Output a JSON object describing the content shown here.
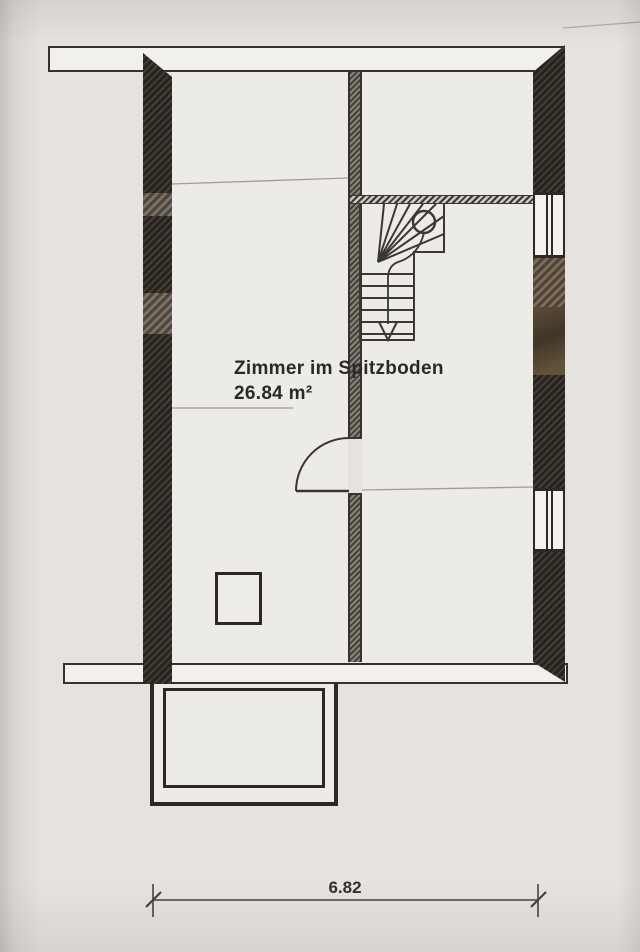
{
  "plan": {
    "room_label": "Zimmer im Spitzboden",
    "room_area": "26.84 m²",
    "dimension": "6.82"
  },
  "colors": {
    "paper": "#e6e3df",
    "wall_black": "#27231f",
    "wall_grey_hatch": "#8b837a",
    "linework": "#3b3833",
    "faint_line": "#a39d94"
  },
  "symbols": [
    {
      "name": "stair-walk-start-circle",
      "meaning": "walking line start of winder staircase"
    },
    {
      "name": "stair-walk-arrow",
      "meaning": "walking line direction arrow (down)"
    },
    {
      "name": "door-swing-arc",
      "meaning": "door swing into left room"
    },
    {
      "name": "dimension-ticks",
      "meaning": "architectural dimension end marks"
    }
  ]
}
